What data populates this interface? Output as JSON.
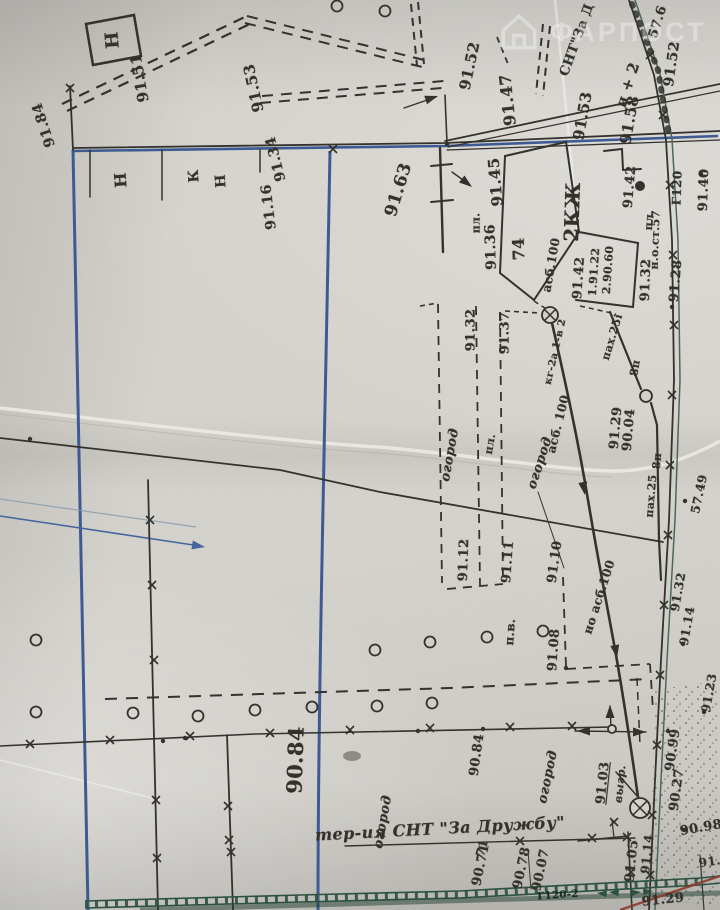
{
  "watermark": {
    "icon": "house-icon",
    "text": "ФАРПОСТ"
  },
  "territory_label": "тер-ия СНТ \"За Дружбу\"",
  "colors": {
    "ink": "#33312c",
    "blue": "#3d5a94",
    "teal_road": "#4c665c",
    "green": "#2a5140",
    "red_line": "#8c3a2b",
    "paper": "#d5d3cd"
  },
  "labels": [
    {
      "text": "Н",
      "x": 113,
      "y": 40,
      "r": -95,
      "s": 18
    },
    {
      "text": "91.51",
      "x": 140,
      "y": 78,
      "r": -100,
      "s": 15
    },
    {
      "text": "91.53",
      "x": 254,
      "y": 88,
      "r": -102,
      "s": 15
    },
    {
      "text": "91.52",
      "x": 470,
      "y": 66,
      "r": -78,
      "s": 15
    },
    {
      "text": "СНТ\"За Д",
      "x": 577,
      "y": 40,
      "r": -70,
      "s": 13
    },
    {
      "text": "н + 2",
      "x": 628,
      "y": 85,
      "r": -72,
      "s": 15
    },
    {
      "text": "57.6",
      "x": 658,
      "y": 22,
      "r": -72,
      "s": 13
    },
    {
      "text": "91.52",
      "x": 672,
      "y": 64,
      "r": -82,
      "s": 14
    },
    {
      "text": "91.47",
      "x": 508,
      "y": 100,
      "r": -96,
      "s": 16
    },
    {
      "text": "91.53",
      "x": 583,
      "y": 116,
      "r": -80,
      "s": 15
    },
    {
      "text": "91.58",
      "x": 630,
      "y": 120,
      "r": -80,
      "s": 15
    },
    {
      "text": "91.42",
      "x": 630,
      "y": 187,
      "r": -85,
      "s": 13
    },
    {
      "text": "91.40",
      "x": 704,
      "y": 190,
      "r": -88,
      "s": 13
    },
    {
      "text": "Г120",
      "x": 677,
      "y": 188,
      "r": -88,
      "s": 12
    },
    {
      "text": "н.о.ст.57",
      "x": 655,
      "y": 240,
      "r": -88,
      "s": 11
    },
    {
      "text": "пл.",
      "x": 649,
      "y": 220,
      "r": -86,
      "s": 11
    },
    {
      "text": "91.32",
      "x": 646,
      "y": 280,
      "r": -88,
      "s": 13
    },
    {
      "text": "91.28",
      "x": 676,
      "y": 281,
      "r": -85,
      "s": 13
    },
    {
      "text": "91.45",
      "x": 496,
      "y": 182,
      "r": -95,
      "s": 15
    },
    {
      "text": "пл.",
      "x": 476,
      "y": 223,
      "r": -90,
      "s": 11
    },
    {
      "text": "91.36",
      "x": 491,
      "y": 247,
      "r": -92,
      "s": 14
    },
    {
      "text": "74",
      "x": 519,
      "y": 249,
      "r": -92,
      "s": 16
    },
    {
      "text": "2КЖ",
      "x": 572,
      "y": 212,
      "r": -88,
      "s": 20
    },
    {
      "text": "асб.100",
      "x": 551,
      "y": 265,
      "r": -80,
      "s": 12
    },
    {
      "text": "91.42",
      "x": 579,
      "y": 278,
      "r": -86,
      "s": 13
    },
    {
      "text": "1.91.22",
      "x": 594,
      "y": 272,
      "r": -86,
      "s": 11
    },
    {
      "text": "2.90.60",
      "x": 608,
      "y": 270,
      "r": -86,
      "s": 11
    },
    {
      "text": "91.63",
      "x": 399,
      "y": 190,
      "r": -73,
      "s": 17
    },
    {
      "text": "Н",
      "x": 121,
      "y": 180,
      "r": -94,
      "s": 16
    },
    {
      "text": "К",
      "x": 194,
      "y": 176,
      "r": -94,
      "s": 14
    },
    {
      "text": "Н",
      "x": 221,
      "y": 181,
      "r": -94,
      "s": 14
    },
    {
      "text": "91.34",
      "x": 276,
      "y": 159,
      "r": -104,
      "s": 14
    },
    {
      "text": "91.16",
      "x": 269,
      "y": 207,
      "r": -97,
      "s": 14
    },
    {
      "text": "91.84",
      "x": 44,
      "y": 125,
      "r": -108,
      "s": 14
    },
    {
      "text": "91.32",
      "x": 471,
      "y": 330,
      "r": -90,
      "s": 13
    },
    {
      "text": "91.37",
      "x": 505,
      "y": 333,
      "r": -90,
      "s": 13
    },
    {
      "text": "кг-2а 1-в 2",
      "x": 556,
      "y": 352,
      "r": -77,
      "s": 10
    },
    {
      "text": "асб. 100",
      "x": 558,
      "y": 424,
      "r": -76,
      "s": 12
    },
    {
      "text": "пах.25i",
      "x": 612,
      "y": 337,
      "r": -73,
      "s": 11
    },
    {
      "text": "8п",
      "x": 635,
      "y": 368,
      "r": -80,
      "s": 11
    },
    {
      "text": "91.29",
      "x": 616,
      "y": 428,
      "r": -85,
      "s": 13
    },
    {
      "text": "90.04",
      "x": 629,
      "y": 430,
      "r": -85,
      "s": 13
    },
    {
      "text": "огород",
      "x": 450,
      "y": 455,
      "r": -80,
      "s": 13,
      "i": true
    },
    {
      "text": "пл.",
      "x": 490,
      "y": 444,
      "r": -80,
      "s": 11
    },
    {
      "text": "огород",
      "x": 540,
      "y": 463,
      "r": -72,
      "s": 13,
      "i": true
    },
    {
      "text": "8п",
      "x": 657,
      "y": 461,
      "r": -85,
      "s": 11
    },
    {
      "text": "пах.25",
      "x": 651,
      "y": 496,
      "r": -85,
      "s": 11
    },
    {
      "text": "57.49",
      "x": 699,
      "y": 494,
      "r": -78,
      "s": 12
    },
    {
      "text": "91.12",
      "x": 464,
      "y": 560,
      "r": -88,
      "s": 13
    },
    {
      "text": "91.11",
      "x": 508,
      "y": 562,
      "r": -86,
      "s": 13
    },
    {
      "text": "91.10",
      "x": 555,
      "y": 562,
      "r": -82,
      "s": 13
    },
    {
      "text": "но асб.100",
      "x": 599,
      "y": 597,
      "r": -72,
      "s": 12
    },
    {
      "text": "91.32",
      "x": 678,
      "y": 592,
      "r": -80,
      "s": 12
    },
    {
      "text": "91.14",
      "x": 687,
      "y": 626,
      "r": -80,
      "s": 12
    },
    {
      "text": "91.08",
      "x": 554,
      "y": 650,
      "r": -86,
      "s": 13
    },
    {
      "text": "п.в.",
      "x": 510,
      "y": 632,
      "r": -86,
      "s": 12
    },
    {
      "text": "91.23",
      "x": 709,
      "y": 693,
      "r": -80,
      "s": 12
    },
    {
      "text": "90.99",
      "x": 673,
      "y": 750,
      "r": -82,
      "s": 13
    },
    {
      "text": "90.27",
      "x": 677,
      "y": 790,
      "r": -82,
      "s": 13
    },
    {
      "text": "91.03",
      "x": 603,
      "y": 783,
      "r": -84,
      "s": 13,
      "u": true
    },
    {
      "text": "выгр.",
      "x": 620,
      "y": 784,
      "r": -84,
      "s": 11,
      "i": true
    },
    {
      "text": "90.84",
      "x": 295,
      "y": 760,
      "r": -88,
      "s": 21
    },
    {
      "text": "90.84",
      "x": 477,
      "y": 755,
      "r": -82,
      "s": 13
    },
    {
      "text": "огород",
      "x": 548,
      "y": 777,
      "r": -78,
      "s": 13,
      "i": true
    },
    {
      "text": "огород",
      "x": 383,
      "y": 822,
      "r": -80,
      "s": 13,
      "i": true
    },
    {
      "text": "тер-ия СНТ \"За Дружбу\"",
      "x": 440,
      "y": 829,
      "r": -3,
      "s": 16,
      "i": true
    },
    {
      "text": "71",
      "x": 482,
      "y": 848,
      "r": -75,
      "s": 12
    },
    {
      "text": "90.71",
      "x": 481,
      "y": 865,
      "r": -78,
      "s": 13
    },
    {
      "text": "90.78",
      "x": 522,
      "y": 868,
      "r": -78,
      "s": 13
    },
    {
      "text": "90.07",
      "x": 541,
      "y": 870,
      "r": -78,
      "s": 13
    },
    {
      "text": "91.05",
      "x": 632,
      "y": 861,
      "r": -84,
      "s": 13
    },
    {
      "text": "91.14",
      "x": 647,
      "y": 854,
      "r": -84,
      "s": 12
    },
    {
      "text": "90.98",
      "x": 701,
      "y": 828,
      "r": -10,
      "s": 13
    },
    {
      "text": "91.0",
      "x": 714,
      "y": 861,
      "r": -8,
      "s": 12
    },
    {
      "text": "91.29",
      "x": 663,
      "y": 900,
      "r": -6,
      "s": 13
    },
    {
      "text": "Г120-2",
      "x": 558,
      "y": 896,
      "r": -4,
      "s": 10,
      "c": "#132b20"
    }
  ],
  "symbols": {
    "post_circles": [
      [
        337,
        6
      ],
      [
        385,
        11
      ],
      [
        36,
        640
      ],
      [
        375,
        650
      ],
      [
        430,
        642
      ],
      [
        487,
        637
      ],
      [
        543,
        631
      ],
      [
        36,
        712
      ],
      [
        133,
        713
      ],
      [
        198,
        716
      ],
      [
        255,
        710
      ],
      [
        312,
        707
      ],
      [
        377,
        706
      ],
      [
        432,
        703
      ]
    ],
    "crossed_circles": [
      [
        550,
        315,
        8
      ],
      [
        640,
        808,
        10
      ]
    ],
    "pole_circles": [
      [
        646,
        396,
        6
      ],
      [
        612,
        729,
        4
      ]
    ],
    "x_marks": [
      [
        70,
        88
      ],
      [
        333,
        149
      ],
      [
        650,
        55
      ],
      [
        663,
        115
      ],
      [
        670,
        185
      ],
      [
        673,
        255
      ],
      [
        674,
        325
      ],
      [
        672,
        395
      ],
      [
        670,
        465
      ],
      [
        668,
        535
      ],
      [
        664,
        605
      ],
      [
        660,
        675
      ],
      [
        657,
        745
      ],
      [
        652,
        815
      ],
      [
        650,
        875
      ],
      [
        30,
        744
      ],
      [
        110,
        740
      ],
      [
        190,
        736
      ],
      [
        270,
        733
      ],
      [
        350,
        730
      ],
      [
        430,
        728
      ],
      [
        510,
        727
      ],
      [
        572,
        726
      ],
      [
        150,
        520
      ],
      [
        152,
        585
      ],
      [
        154,
        660
      ],
      [
        156,
        800
      ],
      [
        157,
        858
      ],
      [
        228,
        806
      ],
      [
        229,
        840
      ],
      [
        231,
        852
      ],
      [
        520,
        841
      ],
      [
        614,
        822
      ],
      [
        627,
        837
      ],
      [
        592,
        838
      ],
      [
        631,
        872
      ]
    ],
    "dots": [
      [
        447,
        144
      ],
      [
        701,
        174
      ],
      [
        672,
        307
      ],
      [
        685,
        501
      ],
      [
        683,
        644
      ],
      [
        704,
        712
      ],
      [
        566,
        668
      ],
      [
        185,
        738
      ],
      [
        418,
        731
      ],
      [
        684,
        830
      ],
      [
        483,
        729
      ],
      [
        668,
        731
      ],
      [
        30,
        439
      ],
      [
        163,
        741
      ]
    ],
    "arrowheads": [
      [
        585,
        495,
        80,
        "ink"
      ],
      [
        617,
        658,
        80,
        "ink"
      ],
      [
        205,
        547,
        9,
        "blue"
      ],
      [
        577,
        731,
        180,
        "ink"
      ],
      [
        646,
        732,
        0,
        "ink"
      ],
      [
        610,
        705,
        -90,
        "ink"
      ],
      [
        438,
        96,
        -18,
        "ink"
      ],
      [
        472,
        187,
        38,
        "ink"
      ],
      [
        597,
        893,
        185,
        "green"
      ],
      [
        609,
        892,
        185,
        "green"
      ],
      [
        641,
        892,
        -5,
        "green"
      ],
      [
        653,
        891,
        -5,
        "green"
      ]
    ]
  }
}
